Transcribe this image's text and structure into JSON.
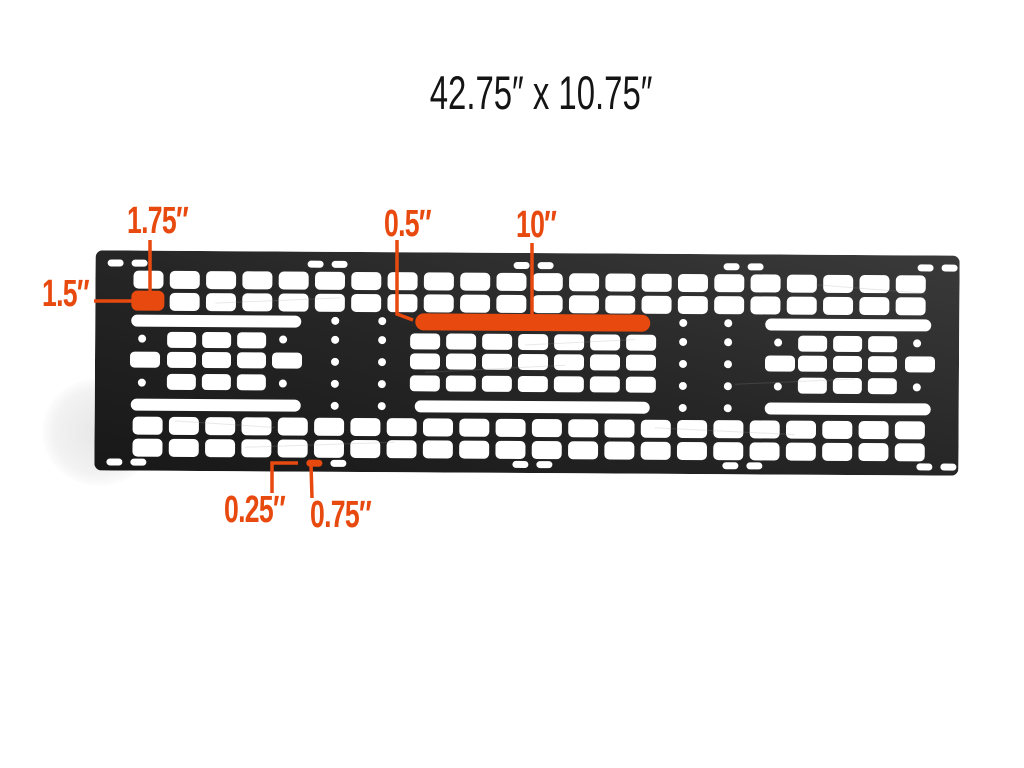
{
  "title": "42.75″ x 10.75″",
  "colors": {
    "accent": "#e8490f",
    "panel_dark": "#1c1c1c",
    "panel_light": "#3a3a3a",
    "slot_white": "#ffffff",
    "background": "#ffffff",
    "title_text": "#141414"
  },
  "annotations": [
    {
      "id": "dim-1-75",
      "label": "1.75″"
    },
    {
      "id": "dim-1-5",
      "label": "1.5″"
    },
    {
      "id": "dim-0-5",
      "label": "0.5″"
    },
    {
      "id": "dim-10",
      "label": "10″"
    },
    {
      "id": "dim-0-25",
      "label": "0.25″"
    },
    {
      "id": "dim-0-75",
      "label": "0.75″"
    }
  ]
}
